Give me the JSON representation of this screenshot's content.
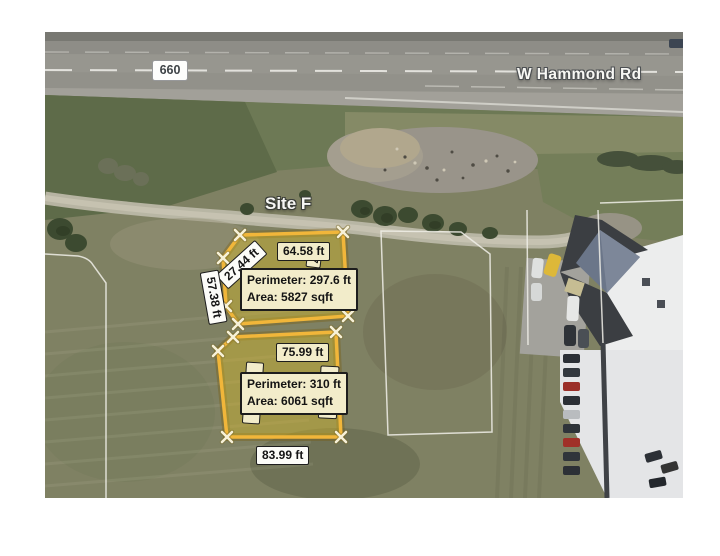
{
  "map": {
    "road": {
      "route_marker": "660",
      "road_name": "W Hammond Rd"
    },
    "site_label": "Site F",
    "parcels": [
      {
        "id": "upper",
        "top_edge": "64.58 ft",
        "diagonal_edge": "27.44 ft",
        "left_edge": "57.38 ft",
        "right_edge_fragment": "7",
        "perimeter_label": "Perimeter: 297.6 ft",
        "area_label": "Area: 5827 sqft"
      },
      {
        "id": "lower",
        "top_edge": "75.99 ft",
        "right_edge": "72.49 ft",
        "bottom_edge": "83.99 ft",
        "perimeter_label": "Perimeter: 310 ft",
        "area_label": "Area: 6061 sqft"
      }
    ],
    "colors": {
      "site_outline": "#f1b63a",
      "site_fill": "rgba(214,184,38,0.42)",
      "measure_label_bg": "#f2ecca",
      "parcel_line": "#f0efe8"
    }
  }
}
